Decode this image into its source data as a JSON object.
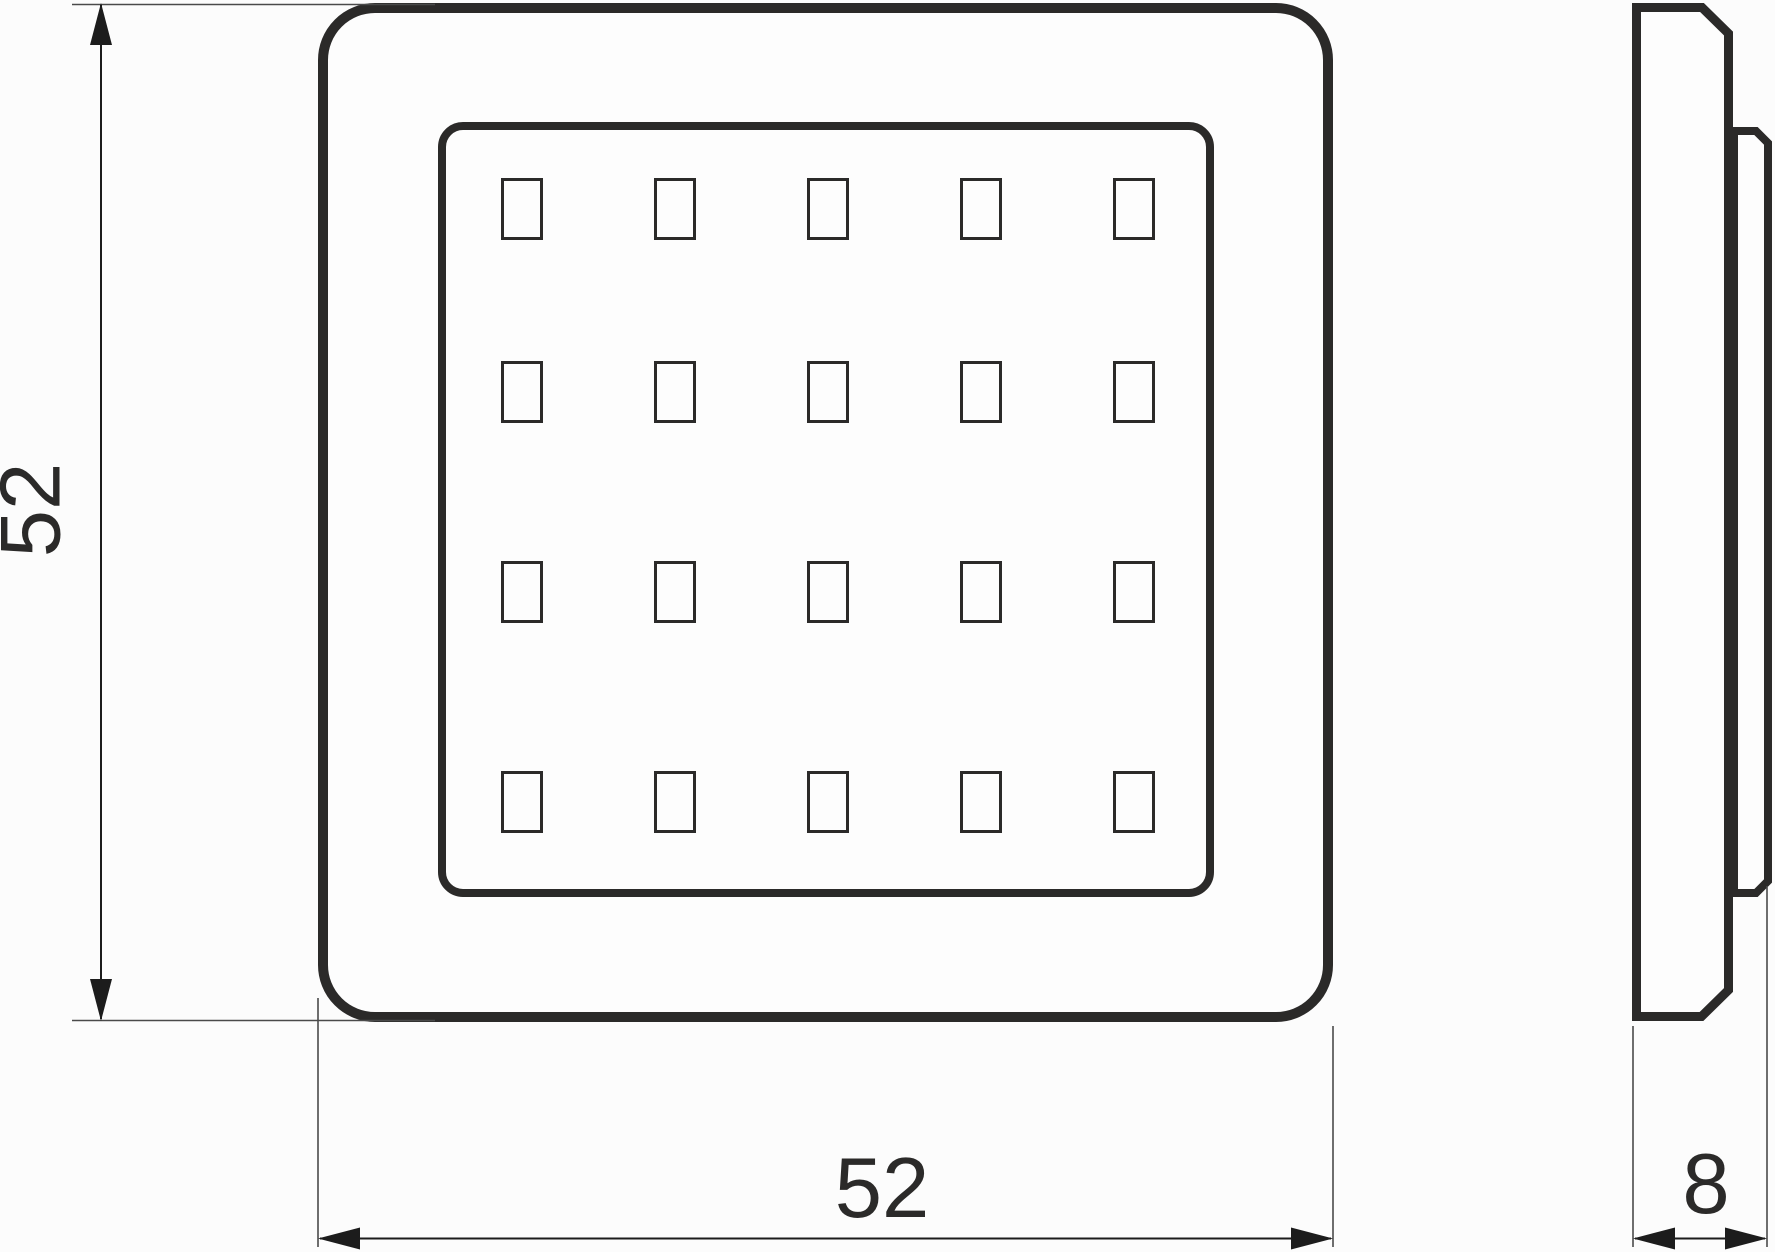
{
  "document": {
    "type": "technical dimension drawing",
    "subject": "square LED panel light — front view and side profile view"
  },
  "dimensions": {
    "height": {
      "label": "52",
      "orientation": "vertical",
      "side": "left"
    },
    "width": {
      "label": "52",
      "orientation": "horizontal",
      "side": "bottom"
    },
    "depth": {
      "label": "8",
      "orientation": "horizontal",
      "side": "bottom-right"
    }
  },
  "front_view": {
    "shape": "rounded square frame with inset rounded square diffuser",
    "led_grid": {
      "rows": 4,
      "cols": 5,
      "led_count": 20,
      "cell_width": 39,
      "cell_height": 59,
      "col_centers": [
        522,
        675,
        828,
        981,
        1134
      ],
      "row_centers": [
        209,
        392,
        592,
        802
      ]
    }
  },
  "side_view": {
    "shape": "thin front plate with chamfered right corners and recessed rear housing"
  },
  "colors": {
    "outline": "#2b2a29",
    "dimension_line": "#1c1c1c",
    "extension_line": "#4a4a4a",
    "background": "#fcfcfc"
  }
}
